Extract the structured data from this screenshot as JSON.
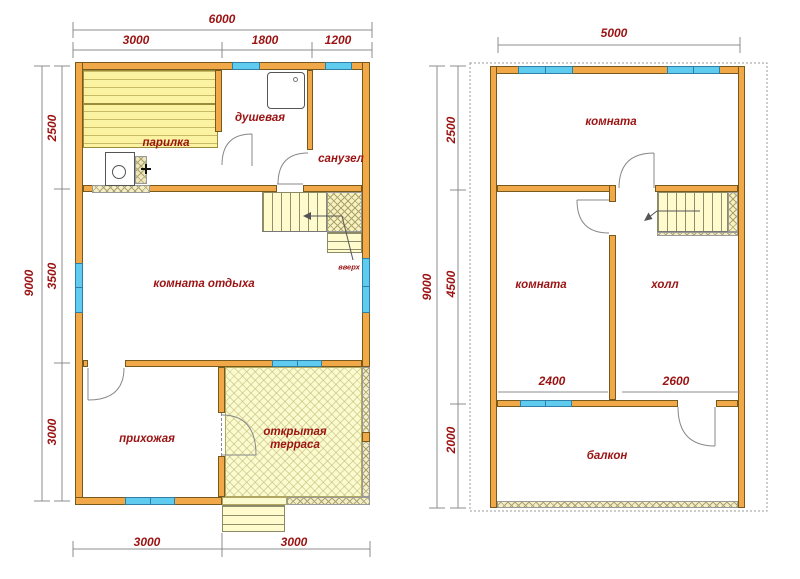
{
  "drawing": "house floor plans",
  "colors": {
    "wall": "#F0A848",
    "window": "#5ECBEF",
    "stairs_fill": "#FFFBCC",
    "terrace_fill": "#FBFBD0",
    "label_text": "#9B1313",
    "lines": "#8C8C8C"
  },
  "f1": {
    "rooms": {
      "sauna": "парилка",
      "shower": "душевая",
      "wc": "санузел",
      "lounge": "комната отдыха",
      "hallway": "прихожая",
      "terrace_line1": "открытая",
      "terrace_line2": "терраса",
      "stairs_up": "вверх"
    },
    "dims": {
      "top_total": "6000",
      "top_seg1": "3000",
      "top_seg2": "1800",
      "top_seg3": "1200",
      "left_total": "9000",
      "left_seg1": "2500",
      "left_seg2": "3500",
      "left_seg3": "3000",
      "bottom_seg1": "3000",
      "bottom_seg2": "3000"
    }
  },
  "f2": {
    "rooms": {
      "room_top": "комната",
      "room_mid": "комната",
      "hall": "холл",
      "balcony": "балкон"
    },
    "dims": {
      "top_total": "5000",
      "left_total": "9000",
      "left_seg1": "2500",
      "left_seg2": "4500",
      "left_seg3": "2000",
      "inner_seg1": "2400",
      "inner_seg2": "2600"
    }
  }
}
